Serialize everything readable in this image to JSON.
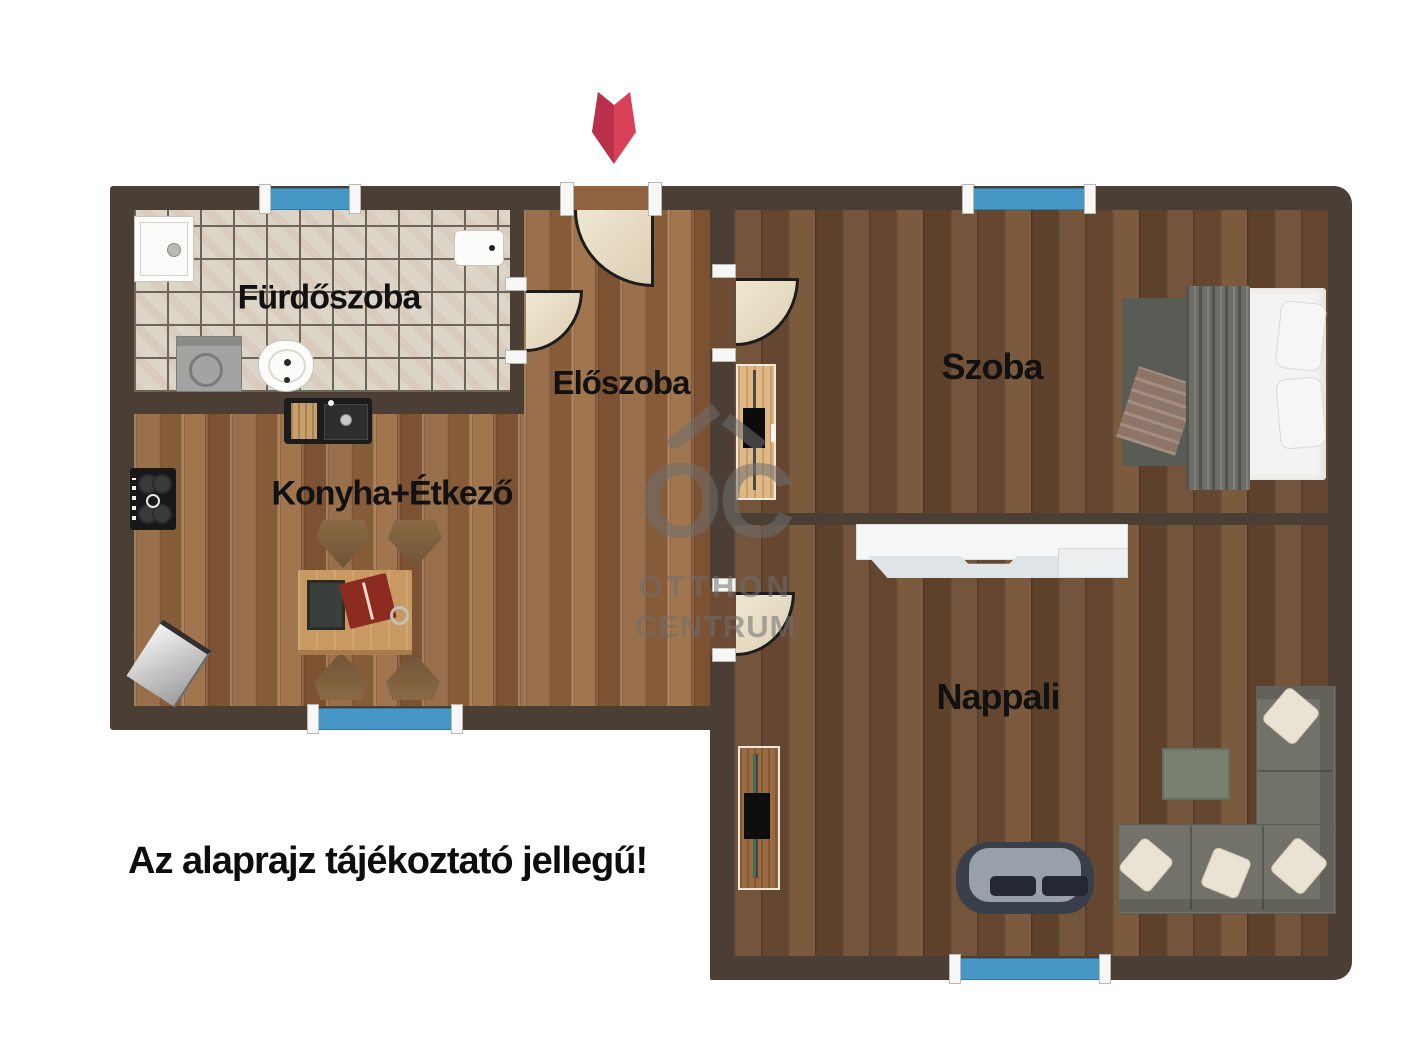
{
  "disclaimer": "Az alaprajz tájékoztató jellegű!",
  "watermark": {
    "monogram": "OC",
    "line1": "OTTHON",
    "line2": "CENTRUM"
  },
  "rooms": {
    "bathroom": {
      "label": "Fürdőszoba"
    },
    "hallway": {
      "label": "Előszoba"
    },
    "kitchen": {
      "label": "Konyha+Étkező"
    },
    "bedroom": {
      "label": "Szoba"
    },
    "living": {
      "label": "Nappali"
    }
  },
  "features": {
    "entrance_marker": "red arrow pointing down at entrance door",
    "windows": [
      {
        "room": "bathroom",
        "wall": "top"
      },
      {
        "room": "bedroom",
        "wall": "top"
      },
      {
        "room": "kitchen",
        "wall": "bottom"
      },
      {
        "room": "living",
        "wall": "bottom"
      }
    ],
    "doors": [
      {
        "from": "outside",
        "to": "hallway"
      },
      {
        "from": "hallway",
        "to": "bathroom"
      },
      {
        "from": "hallway",
        "to": "bedroom"
      },
      {
        "from": "hallway",
        "to": "living"
      }
    ],
    "furniture": {
      "bathroom": [
        "shower-tray",
        "washbasin",
        "washing-machine",
        "toilet"
      ],
      "kitchen": [
        "kitchen-sink",
        "stove",
        "dining-table",
        "chairs",
        "basket"
      ],
      "bedroom": [
        "double-bed",
        "tv-stand"
      ],
      "living": [
        "sideboard",
        "tv-cabinet",
        "loveseat",
        "corner-sofa",
        "coffee-table"
      ]
    }
  },
  "colors": {
    "wall": "#4b3e34",
    "floor_hall_kitchen": "#8f6240",
    "floor_rooms": "#6d4c33",
    "bathroom_tile": "#ddd6c8",
    "window": "#4697c6",
    "door": "#e9dfc9",
    "arrow": "#d84158",
    "watermark": "#6f6f6f",
    "label_text": "#111111"
  }
}
